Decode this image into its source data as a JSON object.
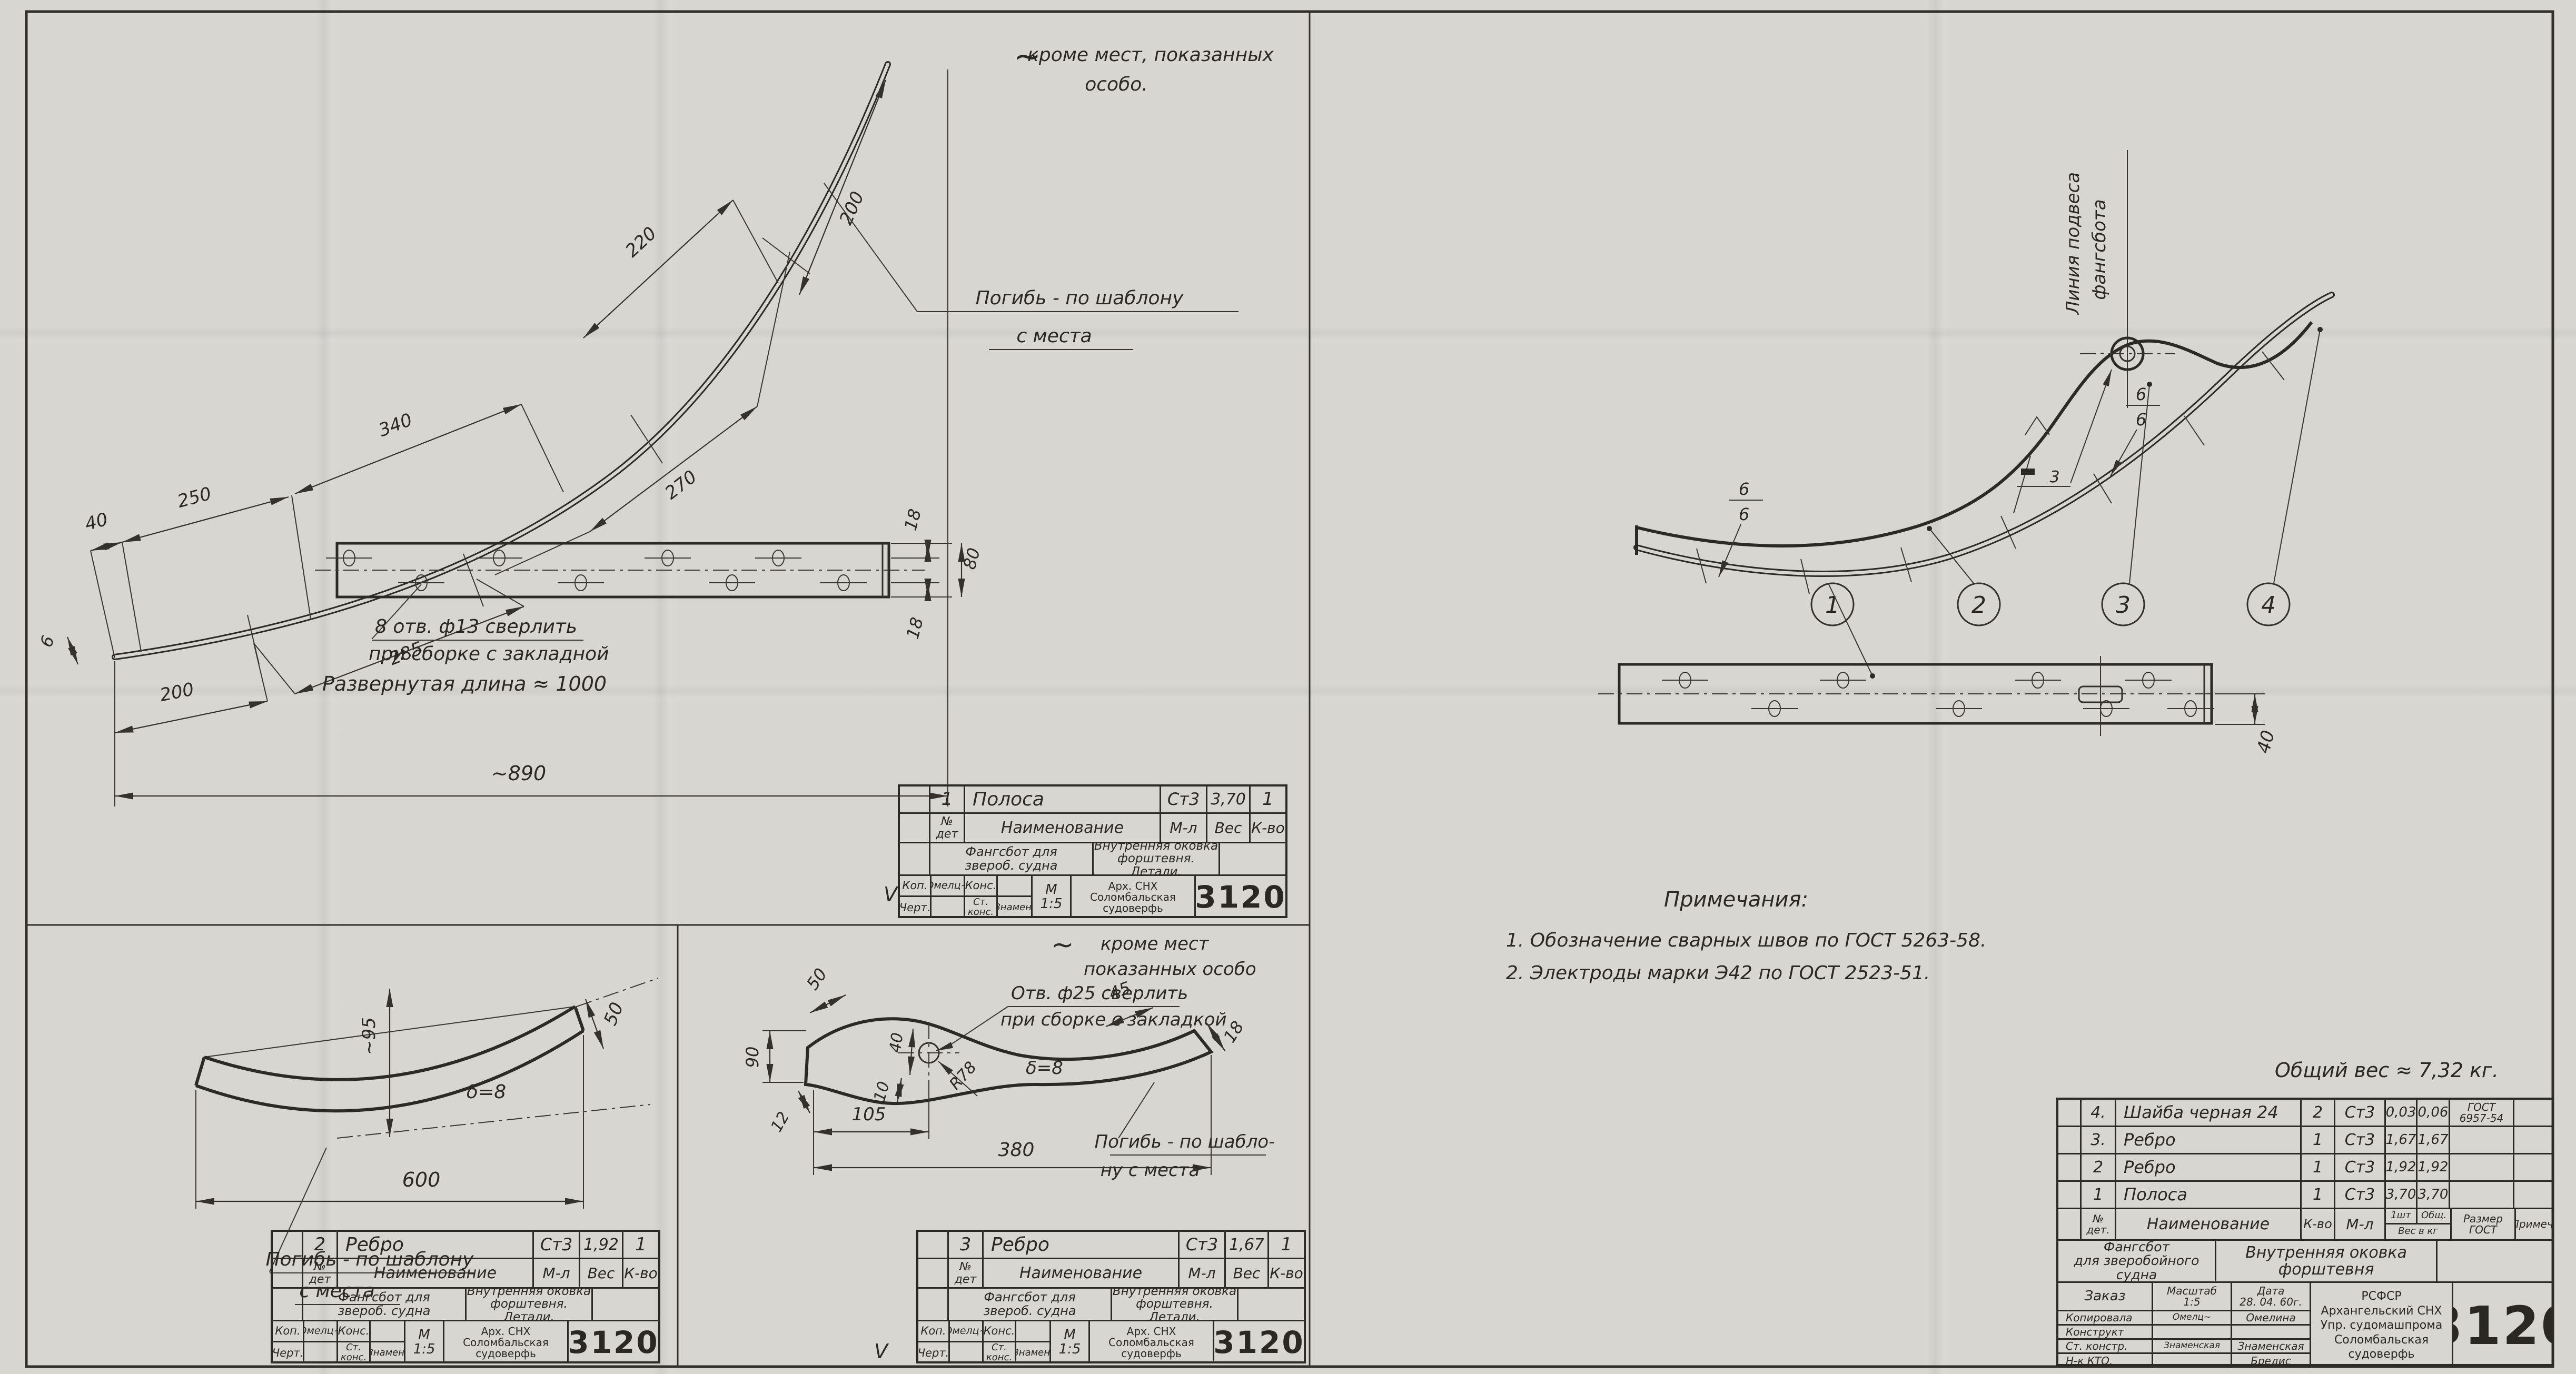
{
  "sheet": {
    "number": "3120"
  },
  "notes": {
    "extra_top": {
      "tilde": "~",
      "l1": "кроме мест, показанных",
      "l2": "особо."
    },
    "extra_mid": {
      "tilde": "~",
      "l1": "кроме мест",
      "l2": "показанных особо"
    },
    "pogib": {
      "l1": "Погибь - по шаблону",
      "l2": "с места"
    },
    "pogib_wrap": {
      "l1": "Погибь - по шабло-",
      "l2": "ну с места"
    },
    "holes8": {
      "l1": "8 отв. ф13 сверлить",
      "l2": "при сборке с закладной"
    },
    "hole25": {
      "l1": "Отв. ф25 сверлить",
      "l2": "при сборке с закладкой"
    },
    "developed": "Развернутая длина ≈ 1000",
    "suspension": {
      "l1": "Линия подвеса",
      "l2": "фангсбота"
    },
    "total_weight": "Общий вес ≈ 7,32 кг.",
    "remarks": {
      "title": "Примечания:",
      "i1": "1. Обозначение сварных швов по ГОСТ 5263-58.",
      "i2": "2. Электроды марки Э42 по ГОСТ 2523-51."
    },
    "check": "V"
  },
  "dims": {
    "a": {
      "d40": "40",
      "d250": "250",
      "d340": "340",
      "d220": "220",
      "d200t": "200",
      "d200b": "200",
      "d285": "285",
      "d270": "270",
      "d890": "~890",
      "d6": "6",
      "d18t": "18",
      "d80": "80",
      "d18b": "18"
    },
    "b": {
      "d95": "~95",
      "delta": "δ=8",
      "d600": "600",
      "d50": "50"
    },
    "c": {
      "d50": "50",
      "d90": "90",
      "d12": "12",
      "d40": "40",
      "d10": "10",
      "r78": "R78",
      "d105": "105",
      "d380": "380",
      "d45": "45",
      "d18": "18",
      "delta": "δ=8"
    },
    "d": {
      "d40": "40",
      "w1n": "6",
      "w1d": "6",
      "w2n": "6",
      "w2d": "6",
      "flag": "3",
      "b1": "1",
      "b2": "2",
      "b3": "3",
      "b4": "4"
    }
  },
  "tbA": {
    "det": "1",
    "name": "Полоса",
    "mat": "Ст3",
    "weight": "3,70",
    "qty": "1",
    "h_no1": "№",
    "h_no2": "дет",
    "h_name": "Наименование",
    "h_mat": "М-л",
    "h_w": "Вес",
    "h_q": "К-во",
    "proj1": "Фангсбот для",
    "proj2": "звероб. судна",
    "title1": "Внутренняя оковка",
    "title2": "форштевня. Детали.",
    "kop": "Коп.",
    "sig1": "Омелц~",
    "kons": "Конс.",
    "chert": "Черт.",
    "stk1": "Ст.",
    "stk2": "конс.",
    "sig2": "Знамен.",
    "m": "М",
    "scale": "1:5",
    "org1": "Арх. СНХ",
    "org2": "Соломбальская",
    "org3": "судоверфь",
    "num": "3120"
  },
  "tbB": {
    "det": "2",
    "name": "Ребро",
    "mat": "Ст3",
    "weight": "1,92",
    "qty": "1",
    "h_no1": "№",
    "h_no2": "дет",
    "h_name": "Наименование",
    "h_mat": "М-л",
    "h_w": "Вес",
    "h_q": "К-во",
    "proj1": "Фангсбот для",
    "proj2": "звероб. судна",
    "title1": "Внутренняя оковка",
    "title2": "форштевня. Детали.",
    "kop": "Коп.",
    "sig1": "Омелц~",
    "kons": "Конс.",
    "chert": "Черт.",
    "stk1": "Ст.",
    "stk2": "конс.",
    "sig2": "Знамен.",
    "m": "М",
    "scale": "1:5",
    "org1": "Арх. СНХ",
    "org2": "Соломбальская",
    "org3": "судоверфь",
    "num": "3120"
  },
  "tbC": {
    "det": "3",
    "name": "Ребро",
    "mat": "Ст3",
    "weight": "1,67",
    "qty": "1",
    "h_no1": "№",
    "h_no2": "дет",
    "h_name": "Наименование",
    "h_mat": "М-л",
    "h_w": "Вес",
    "h_q": "К-во",
    "proj1": "Фангсбот для",
    "proj2": "звероб. судна",
    "title1": "Внутренняя оковка",
    "title2": "форштевня. Детали.",
    "kop": "Коп.",
    "sig1": "Омелц~",
    "kons": "Конс.",
    "chert": "Черт.",
    "stk1": "Ст.",
    "stk2": "конс.",
    "sig2": "Знамен.",
    "m": "М",
    "scale": "1:5",
    "org1": "Арх. СНХ",
    "org2": "Соломбальская",
    "org3": "судоверфь",
    "num": "3120"
  },
  "parts": {
    "header": {
      "no1": "№",
      "no2": "дет.",
      "name": "Наименование",
      "qty": "К-во",
      "mat": "М-л",
      "w1": "1шт",
      "w2": "Общ.",
      "wsub": "Вес в кг",
      "gost1": "Размер",
      "gost2": "ГОСТ",
      "prim": "Примеч."
    },
    "rows": [
      {
        "no": "4.",
        "name": "Шайба черная 24",
        "qty": "2",
        "mat": "Ст3",
        "w1": "0,03",
        "w2": "0,06",
        "gost1": "ГОСТ",
        "gost2": "6957-54",
        "prim": ""
      },
      {
        "no": "3.",
        "name": "Ребро",
        "qty": "1",
        "mat": "Ст3",
        "w1": "1,67",
        "w2": "1,67",
        "gost1": "",
        "gost2": "",
        "prim": ""
      },
      {
        "no": "2",
        "name": "Ребро",
        "qty": "1",
        "mat": "Ст3",
        "w1": "1,92",
        "w2": "1,92",
        "gost1": "",
        "gost2": "",
        "prim": ""
      },
      {
        "no": "1",
        "name": "Полоса",
        "qty": "1",
        "mat": "Ст3",
        "w1": "3,70",
        "w2": "3,70",
        "gost1": "",
        "gost2": "",
        "prim": ""
      }
    ]
  },
  "main": {
    "proj1": "Фангсбот",
    "proj2": "для зверобойного",
    "proj3": "судна",
    "title1": "Внутренняя оковка",
    "title2": "форштевня",
    "zakaz": "Заказ",
    "masshtab": "Масштаб",
    "scale": "1:5",
    "date_lbl": "Дата",
    "date": "28. 04. 60г.",
    "r1l": "Копировала",
    "r1s": "Омелц~",
    "r1n": "Омелина",
    "r2l": "Конструкт",
    "r2s": "",
    "r2n": "",
    "r3l": "Ст. констр.",
    "r3s": "Знаменская",
    "r3n": "Знаменская",
    "r4l": "Н-к КТО.",
    "r4s": "",
    "r4n": "Бредис",
    "org1": "РСФСР",
    "org2": "Архангельский СНХ",
    "org3": "Упр. судомашпрома",
    "org4": "Соломбальская",
    "org5": "судоверфь",
    "num": "3120"
  }
}
